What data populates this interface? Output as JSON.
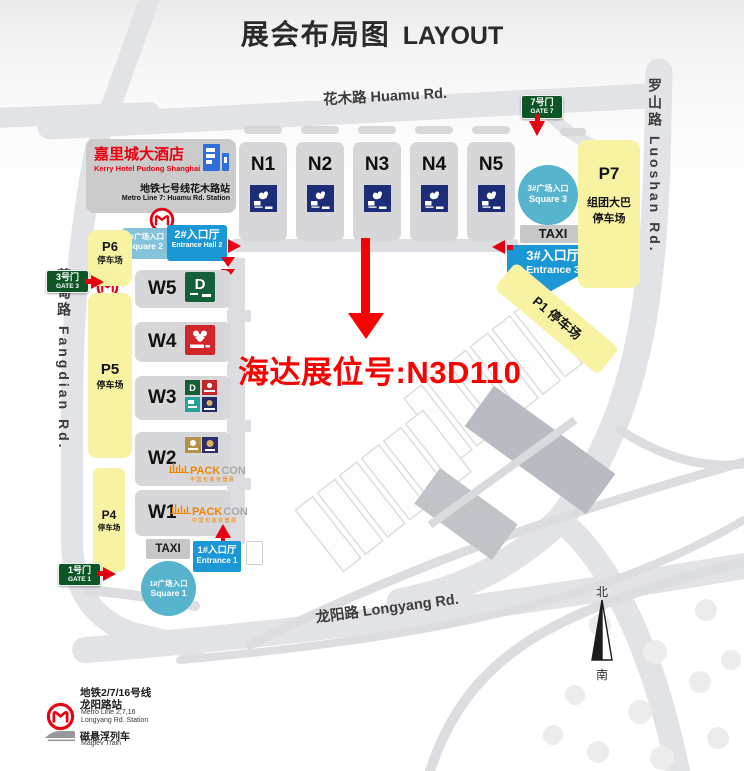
{
  "title": {
    "zh": "展会布局图",
    "en": "LAYOUT"
  },
  "roads": {
    "huamu": "花木路 Huamu Rd.",
    "fangdian": "芳甸路 Fangdian Rd.",
    "luoshan": "罗山路 Luoshan Rd.",
    "longyang": "龙阳路 Longyang Rd."
  },
  "hotel": {
    "name_zh": "嘉里城大酒店",
    "name_en": "Kerry Hotel Pudong Shanghai",
    "station_zh": "地铁七号线花木路站",
    "station_en": "Metro Line 7: Huamu Rd. Station"
  },
  "gates": {
    "gate7_zh": "7号门",
    "gate7_en": "GATE 7",
    "gate3_zh": "3号门",
    "gate3_en": "GATE 3",
    "gate1_zh": "1号门",
    "gate1_en": "GATE 1"
  },
  "halls_north": [
    "N1",
    "N2",
    "N3",
    "N4",
    "N5"
  ],
  "halls_west": [
    "W5",
    "W4",
    "W3",
    "W2",
    "W1"
  ],
  "entrances": {
    "square2_zh": "2#广场入口",
    "square2_en": "Square 2",
    "hall2_zh": "2#入口厅",
    "hall2_en": "Entrance Hall 2",
    "square3_zh": "3#广场入口",
    "square3_en": "Square 3",
    "hall3_zh": "3#入口厅",
    "hall3_en": "Entrance 3",
    "square1_zh": "1#广场入口",
    "square1_en": "Square 1",
    "hall1_zh": "1#入口厅",
    "hall1_en": "Entrance 1",
    "taxi_north": "TAXI",
    "taxi_south": "TAXI"
  },
  "parking": {
    "p7_label": "P7",
    "p7_line1": "组团大巴",
    "p7_line2": "停车场",
    "p6_label": "P6",
    "p6_sub": "停车场",
    "p5_label": "P5",
    "p5_sub": "停车场",
    "p4_label": "P4",
    "p4_sub": "停车场",
    "p1_label": "P1 停车场"
  },
  "annotation": {
    "booth_text": "海达展位号:N3D110"
  },
  "logos": {
    "packcon_pack": "PACK",
    "packcon_con": "CON",
    "packcon_sub": "中国包装容器展"
  },
  "legend": {
    "metro_line1_zh": "地铁2/7/16号线",
    "metro_line2_zh": "龙阳路站",
    "metro_line1_en": "Metro Line 2,7,16",
    "metro_line2_en": "Longyang Rd. Station",
    "maglev_zh": "磁悬浮列车",
    "maglev_en": "Maglev Train"
  },
  "compass": {
    "north": "北",
    "south": "南"
  },
  "colors": {
    "accent_red": "#e60012",
    "entrance_blue": "#1b97d5",
    "square_teal": "#58b4cc",
    "parking_yellow": "#f7f3a2",
    "gate_green": "#0d5426",
    "hall_gray": "#d7d7d9",
    "logo_navy": "#1e2d78"
  }
}
